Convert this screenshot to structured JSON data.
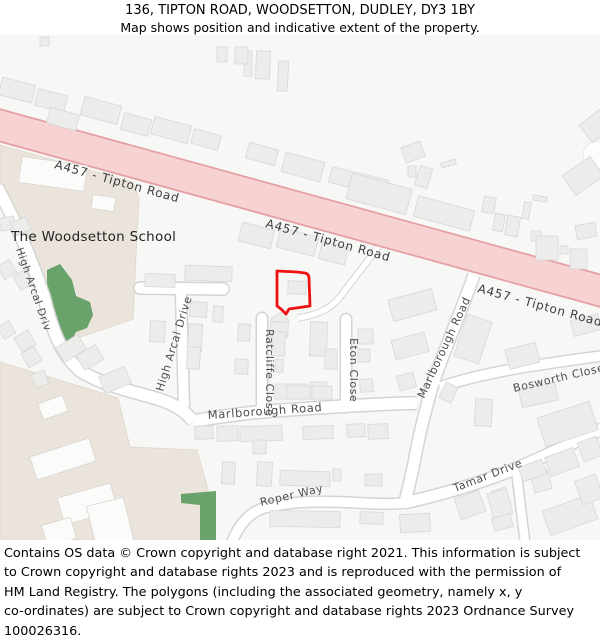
{
  "header": {
    "title": "136, TIPTON ROAD, WOODSETTON, DUDLEY, DY3 1BY",
    "subtitle": "Map shows position and indicative extent of the property."
  },
  "map": {
    "place_labels": {
      "school": "The Woodsetton School"
    },
    "road_labels": {
      "a457_1": "A457 - Tipton Road",
      "a457_2": "A457 - Tipton Road",
      "a457_3": "A457 - Tipton Road",
      "high_arcal_west": "High Arcal Drive",
      "high_arcal_east": "High Arcal Drive",
      "ratcliffe": "Ratcliffe Close",
      "eton": "Eton Close",
      "marlborough_ew": "Marlborough Road",
      "marlborough_ns": "Marlborough Road",
      "bosworth": "Bosworth Close",
      "tamar": "Tamar Drive",
      "roper": "Roper Way"
    },
    "colors": {
      "a_road_fill": "#f7d2d3",
      "a_road_casing": "#e59fa2",
      "road_fill": "#ffffff",
      "road_casing": "#d4d4d2",
      "building_fill": "#ececeb",
      "building_stroke": "#d7d7d5",
      "school_area": "#eae4dc",
      "green_area": "#69a36b",
      "background": "#f7f7f6",
      "property_outline": "#ee1111"
    }
  },
  "footer": {
    "lines": [
      "Contains OS data © Crown copyright and database right 2021. This information is subject",
      "to Crown copyright and database rights 2023 and is reproduced with the permission of",
      "HM Land Registry. The polygons (including the associated geometry, namely x, y",
      "co-ordinates) are subject to Crown copyright and database rights 2023 Ordnance Survey",
      "100026316."
    ]
  }
}
